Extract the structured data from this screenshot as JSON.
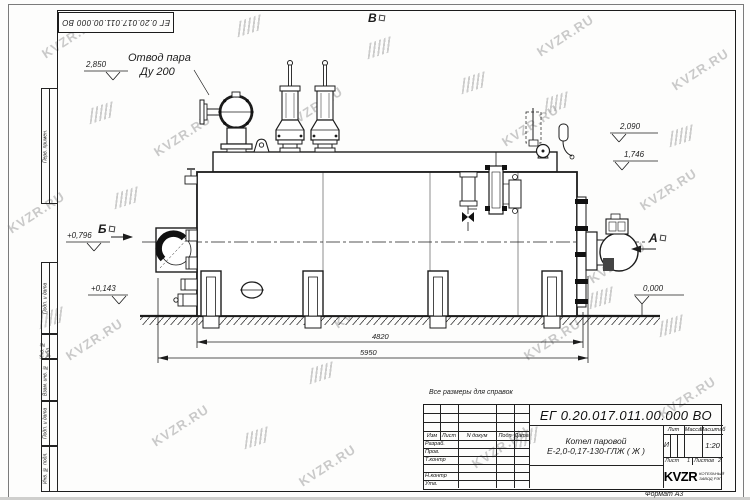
{
  "watermark": {
    "text": "KVZR.RU"
  },
  "stamp_top": {
    "doc_number": "ЕГ 0.20.017.011.00.000  ВО"
  },
  "margin": [
    "Перв. примен.",
    "Подп. и дата",
    "Инв. № дубл.",
    "Взам. инв. №",
    "Подп. и дата",
    "Инв. № подл."
  ],
  "annotations": {
    "note": "Все размеры для справок",
    "steam_outlet_line1": "Отвод пара",
    "steam_outlet_line2": "Ду 200",
    "elev_steam": "2,850",
    "elev_top": "2,090",
    "elev_casing": "1,746",
    "elev_front_upper": "+0,796",
    "elev_front_lower": "+0,143",
    "elev_zero": "0,000",
    "view_a": "А",
    "view_b": "Б",
    "view_v": "В",
    "dim_inner": "4820",
    "dim_overall": "5950"
  },
  "title_block": {
    "doc_number": "ЕГ 0.20.017.011.00.000  ВО",
    "name_line1": "Котел паровой",
    "name_line2": "Е-2,0-0,17-130-ГЛЖ ( Ж )",
    "col_izm": "Изм",
    "col_list": "Лист",
    "col_ndoc": "N докум",
    "col_podp": "Подп",
    "col_data": "Дата",
    "rows": [
      "Разраб.",
      "Пров.",
      "Т.контр",
      "",
      "Н.контр",
      "Утв."
    ],
    "lit_header": "Лит",
    "massa_header": "Масса",
    "masshtab_header": "Масштаб",
    "lit_value": "И",
    "scale_value": "1:20",
    "sheet_label": "Лист",
    "sheet_value": "1",
    "sheets_label": "Листов",
    "sheets_value": "2",
    "logo_text": "KVZR",
    "logo_sub1": "КОТЕЛЬНЫЙ",
    "logo_sub2": "ЗАВОД РЭП",
    "format_label": "Формат А3"
  }
}
